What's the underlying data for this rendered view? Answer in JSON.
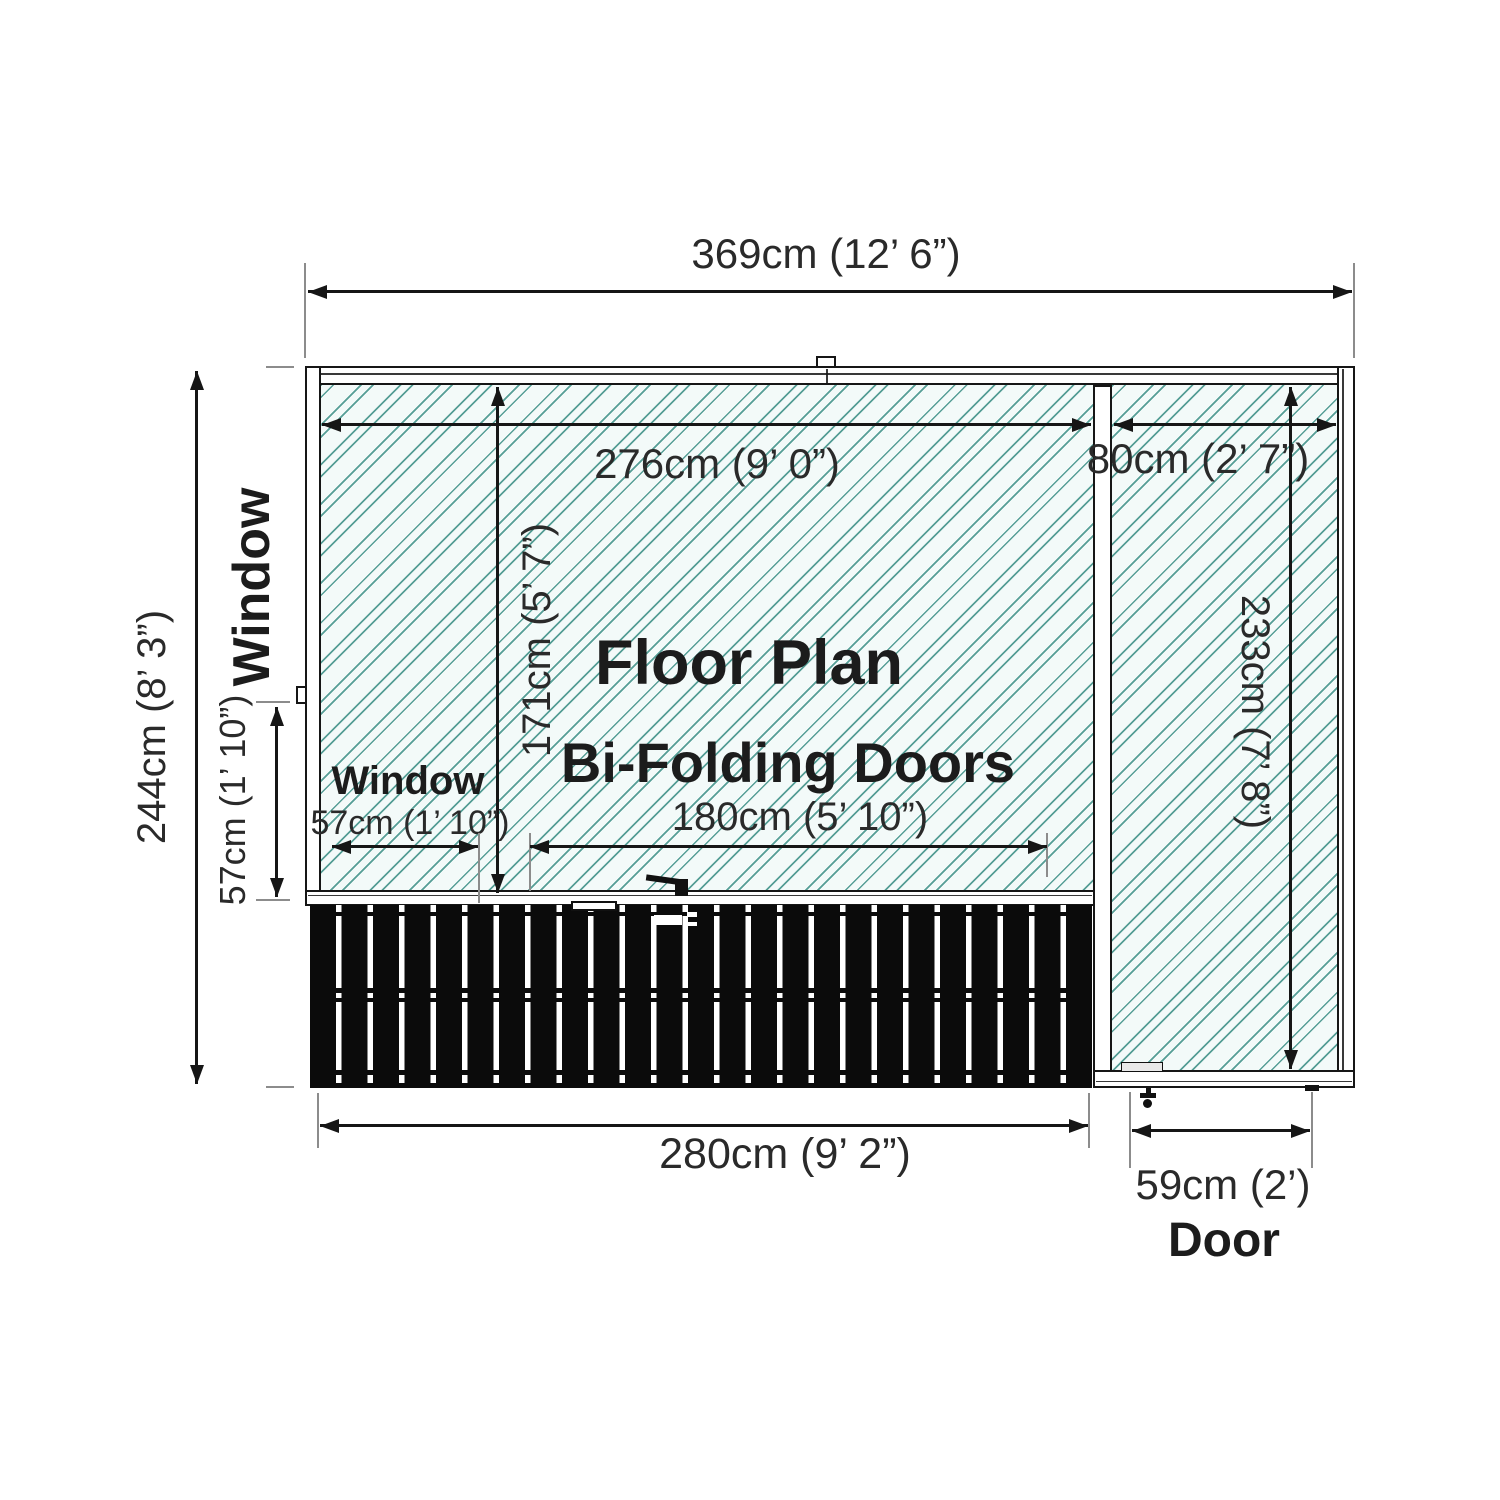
{
  "diagram": {
    "title": "Floor Plan",
    "subtitle": "Bi-Folding Doors",
    "dims": {
      "overall_width": "369cm (12’ 6”)",
      "main_internal_width": "276cm (9’ 0”)",
      "annex_internal_width": "80cm (2’ 7”)",
      "main_internal_depth": "171cm (5’ 7”)",
      "annex_internal_depth": "233cm (7’ 8”)",
      "overall_depth": "244cm (8’ 3”)",
      "side_window_size": "57cm (1’ 10”)",
      "front_window_size": "57cm (1’ 10”)",
      "bifold_doors_width": "180cm (5’ 10”)",
      "front_section_width": "280cm (9’ 2”)",
      "door_width": "59cm (2’)"
    },
    "labels": {
      "side_window": "Window",
      "front_window": "Window",
      "door": "Door"
    },
    "colors": {
      "hatch_line": "#569e96",
      "hatch_background": "#f3faf9",
      "outline": "#161616",
      "doors_fill": "#0b0b0b",
      "extension_gray": "#8c8c8c"
    }
  }
}
